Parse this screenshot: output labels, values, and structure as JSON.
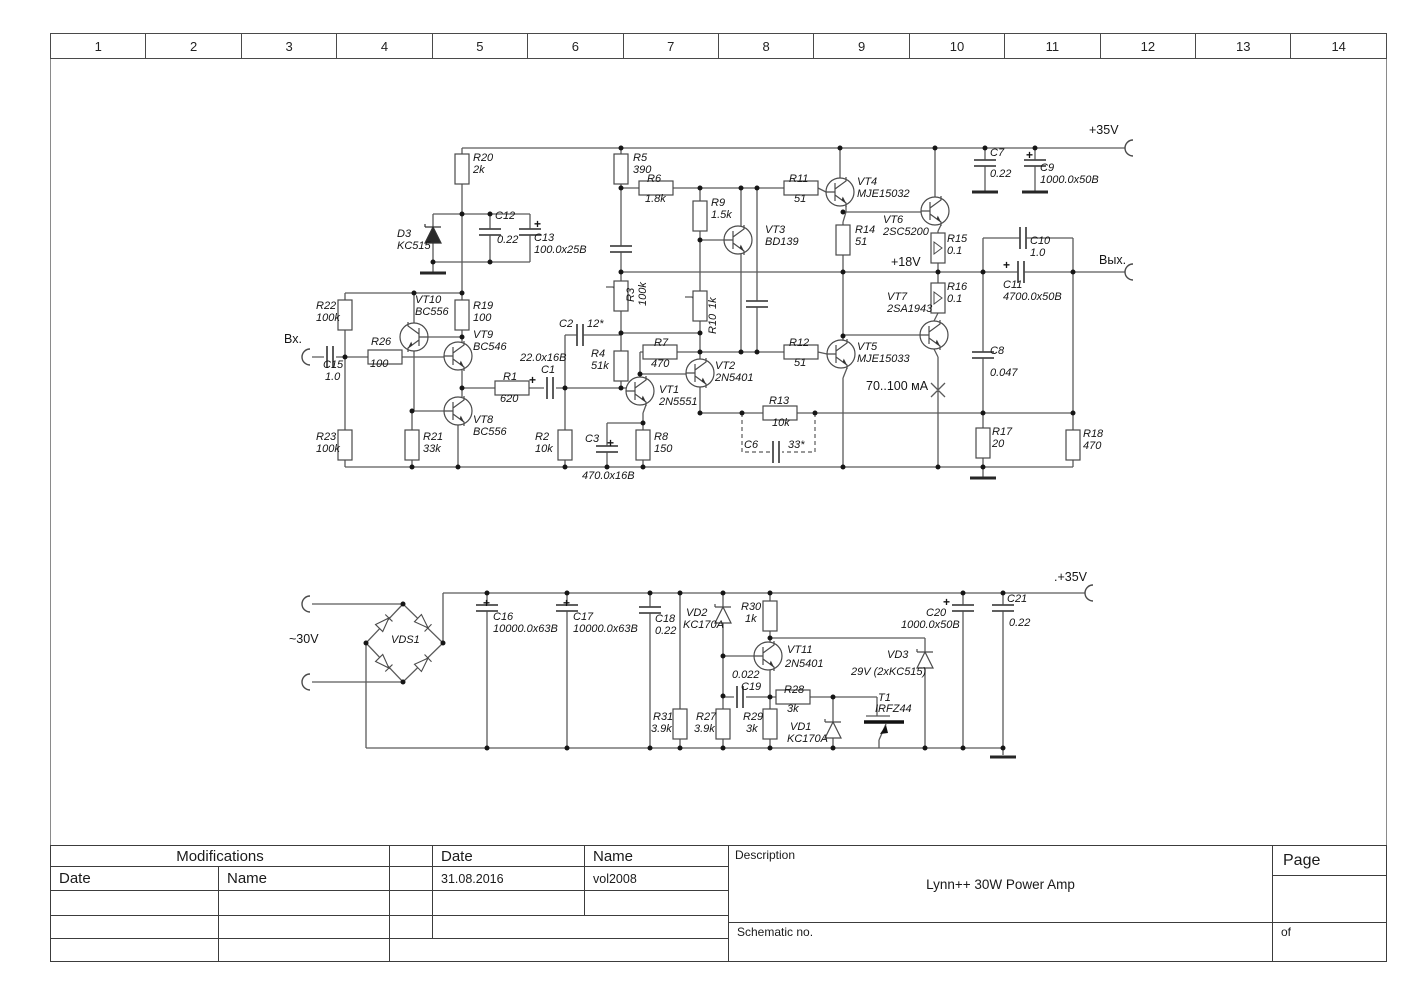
{
  "frame": {
    "columns": [
      "1",
      "2",
      "3",
      "4",
      "5",
      "6",
      "7",
      "8",
      "9",
      "10",
      "11",
      "12",
      "13",
      "14"
    ]
  },
  "title_block": {
    "modifications": "Modifications",
    "date_col": "Date",
    "name_col": "Name",
    "date_header": "Date",
    "name_header": "Name",
    "date_value": "31.08.2016",
    "name_value": "vol2008",
    "description_label": "Description",
    "description": "Lynn++ 30W Power Amp",
    "schematic_no_label": "Schematic no.",
    "page_label": "Page",
    "of_label": "of"
  },
  "schematic": {
    "labels": [
      {
        "x": 473,
        "y": 153,
        "t": "R20"
      },
      {
        "x": 473,
        "y": 165,
        "t": "2k"
      },
      {
        "x": 633,
        "y": 153,
        "t": "R5"
      },
      {
        "x": 633,
        "y": 165,
        "t": "390"
      },
      {
        "x": 647,
        "y": 174,
        "t": "R6"
      },
      {
        "x": 645,
        "y": 194,
        "t": "1.8k"
      },
      {
        "x": 711,
        "y": 198,
        "t": "R9"
      },
      {
        "x": 711,
        "y": 210,
        "t": "1.5k"
      },
      {
        "x": 765,
        "y": 225,
        "t": "VT3"
      },
      {
        "x": 765,
        "y": 237,
        "t": "BD139"
      },
      {
        "x": 789,
        "y": 174,
        "t": "R11"
      },
      {
        "x": 794,
        "y": 194,
        "t": "51"
      },
      {
        "x": 857,
        "y": 177,
        "t": "VT4"
      },
      {
        "x": 857,
        "y": 189,
        "t": "MJE15032"
      },
      {
        "x": 883,
        "y": 215,
        "t": "VT6"
      },
      {
        "x": 883,
        "y": 227,
        "t": "2SC5200"
      },
      {
        "x": 855,
        "y": 225,
        "t": "R14"
      },
      {
        "x": 855,
        "y": 237,
        "t": "51"
      },
      {
        "x": 947,
        "y": 234,
        "t": "R15"
      },
      {
        "x": 947,
        "y": 246,
        "t": "0.1"
      },
      {
        "x": 891,
        "y": 256,
        "t": "+18V",
        "c": "up"
      },
      {
        "x": 947,
        "y": 282,
        "t": "R16"
      },
      {
        "x": 947,
        "y": 294,
        "t": "0.1"
      },
      {
        "x": 887,
        "y": 292,
        "t": "VT7"
      },
      {
        "x": 887,
        "y": 304,
        "t": "2SA1943"
      },
      {
        "x": 990,
        "y": 148,
        "t": "C7"
      },
      {
        "x": 990,
        "y": 169,
        "t": "0.22"
      },
      {
        "x": 1026,
        "y": 149,
        "t": "+",
        "c": "plus"
      },
      {
        "x": 1040,
        "y": 163,
        "t": "C9"
      },
      {
        "x": 1040,
        "y": 175,
        "t": "1000.0x50B"
      },
      {
        "x": 1089,
        "y": 124,
        "t": "+35V",
        "c": "up"
      },
      {
        "x": 1030,
        "y": 236,
        "t": "C10"
      },
      {
        "x": 1030,
        "y": 248,
        "t": "1.0"
      },
      {
        "x": 1003,
        "y": 259,
        "t": "+",
        "c": "plus"
      },
      {
        "x": 1003,
        "y": 280,
        "t": "C11"
      },
      {
        "x": 1003,
        "y": 292,
        "t": "4700.0x50B"
      },
      {
        "x": 1099,
        "y": 254,
        "t": "Вых.",
        "c": "up"
      },
      {
        "x": 990,
        "y": 346,
        "t": "C8"
      },
      {
        "x": 990,
        "y": 368,
        "t": "0.047"
      },
      {
        "x": 397,
        "y": 229,
        "t": "D3"
      },
      {
        "x": 397,
        "y": 241,
        "t": "KC515"
      },
      {
        "x": 495,
        "y": 211,
        "t": "C12"
      },
      {
        "x": 497,
        "y": 235,
        "t": "0.22"
      },
      {
        "x": 534,
        "y": 218,
        "t": "+",
        "c": "plus"
      },
      {
        "x": 534,
        "y": 233,
        "t": "C13"
      },
      {
        "x": 534,
        "y": 245,
        "t": "100.0x25B"
      },
      {
        "x": 316,
        "y": 301,
        "t": "R22"
      },
      {
        "x": 316,
        "y": 313,
        "t": "100k"
      },
      {
        "x": 316,
        "y": 432,
        "t": "R23"
      },
      {
        "x": 316,
        "y": 444,
        "t": "100k"
      },
      {
        "x": 371,
        "y": 337,
        "t": "R26"
      },
      {
        "x": 370,
        "y": 359,
        "t": "100"
      },
      {
        "x": 415,
        "y": 295,
        "t": "VT10"
      },
      {
        "x": 415,
        "y": 307,
        "t": "BC556"
      },
      {
        "x": 473,
        "y": 330,
        "t": "VT9"
      },
      {
        "x": 473,
        "y": 342,
        "t": "BC546"
      },
      {
        "x": 473,
        "y": 301,
        "t": "R19"
      },
      {
        "x": 473,
        "y": 313,
        "t": "100"
      },
      {
        "x": 473,
        "y": 415,
        "t": "VT8"
      },
      {
        "x": 473,
        "y": 427,
        "t": "BC556"
      },
      {
        "x": 423,
        "y": 432,
        "t": "R21"
      },
      {
        "x": 423,
        "y": 444,
        "t": "33k"
      },
      {
        "x": 284,
        "y": 333,
        "t": "Вх.",
        "c": "up"
      },
      {
        "x": 323,
        "y": 360,
        "t": "C15"
      },
      {
        "x": 325,
        "y": 372,
        "t": "1.0"
      },
      {
        "x": 503,
        "y": 372,
        "t": "R1"
      },
      {
        "x": 500,
        "y": 394,
        "t": "620"
      },
      {
        "x": 520,
        "y": 353,
        "t": "22.0x16B"
      },
      {
        "x": 541,
        "y": 365,
        "t": "C1"
      },
      {
        "x": 529,
        "y": 374,
        "t": "+",
        "c": "plus"
      },
      {
        "x": 559,
        "y": 319,
        "t": "C2"
      },
      {
        "x": 587,
        "y": 319,
        "t": "12*"
      },
      {
        "x": 591,
        "y": 349,
        "t": "R4"
      },
      {
        "x": 591,
        "y": 361,
        "t": "51k"
      },
      {
        "x": 535,
        "y": 432,
        "t": "R2"
      },
      {
        "x": 535,
        "y": 444,
        "t": "10k"
      },
      {
        "x": 585,
        "y": 434,
        "t": "C3"
      },
      {
        "x": 607,
        "y": 437,
        "t": "+",
        "c": "plus"
      },
      {
        "x": 582,
        "y": 471,
        "t": "470.0x16B"
      },
      {
        "x": 654,
        "y": 432,
        "t": "R8"
      },
      {
        "x": 654,
        "y": 444,
        "t": "150"
      },
      {
        "x": 654,
        "y": 338,
        "t": "R7"
      },
      {
        "x": 651,
        "y": 359,
        "t": "470"
      },
      {
        "x": 659,
        "y": 385,
        "t": "VT1"
      },
      {
        "x": 659,
        "y": 397,
        "t": "2N5551"
      },
      {
        "x": 715,
        "y": 361,
        "t": "VT2"
      },
      {
        "x": 715,
        "y": 373,
        "t": "2N5401"
      },
      {
        "x": 626,
        "y": 302,
        "t": "R3",
        "c": "rot"
      },
      {
        "x": 638,
        "y": 306,
        "t": "100k",
        "c": "rot"
      },
      {
        "x": 708,
        "y": 334,
        "t": "R10",
        "c": "rot"
      },
      {
        "x": 708,
        "y": 309,
        "t": "1k",
        "c": "rot"
      },
      {
        "x": 789,
        "y": 338,
        "t": "R12"
      },
      {
        "x": 794,
        "y": 358,
        "t": "51"
      },
      {
        "x": 857,
        "y": 342,
        "t": "VT5"
      },
      {
        "x": 857,
        "y": 354,
        "t": "MJE15033"
      },
      {
        "x": 866,
        "y": 380,
        "t": "70..100 мА",
        "c": "up"
      },
      {
        "x": 769,
        "y": 396,
        "t": "R13"
      },
      {
        "x": 772,
        "y": 418,
        "t": "10k"
      },
      {
        "x": 744,
        "y": 440,
        "t": "C6"
      },
      {
        "x": 788,
        "y": 440,
        "t": "33*"
      },
      {
        "x": 992,
        "y": 427,
        "t": "R17"
      },
      {
        "x": 992,
        "y": 439,
        "t": "20"
      },
      {
        "x": 1083,
        "y": 429,
        "t": "R18"
      },
      {
        "x": 1083,
        "y": 441,
        "t": "470"
      },
      {
        "x": 289,
        "y": 633,
        "t": "~30V",
        "c": "up"
      },
      {
        "x": 391,
        "y": 635,
        "t": "VDS1"
      },
      {
        "x": 483,
        "y": 597,
        "t": "+",
        "c": "plus"
      },
      {
        "x": 493,
        "y": 612,
        "t": "C16"
      },
      {
        "x": 493,
        "y": 624,
        "t": "10000.0x63B"
      },
      {
        "x": 563,
        "y": 597,
        "t": "+",
        "c": "plus"
      },
      {
        "x": 573,
        "y": 612,
        "t": "C17"
      },
      {
        "x": 573,
        "y": 624,
        "t": "10000.0x63B"
      },
      {
        "x": 655,
        "y": 614,
        "t": "C18"
      },
      {
        "x": 655,
        "y": 626,
        "t": "0.22"
      },
      {
        "x": 686,
        "y": 608,
        "t": "VD2"
      },
      {
        "x": 683,
        "y": 620,
        "t": "KC170A"
      },
      {
        "x": 741,
        "y": 602,
        "t": "R30"
      },
      {
        "x": 745,
        "y": 614,
        "t": "1k"
      },
      {
        "x": 787,
        "y": 645,
        "t": "VT11"
      },
      {
        "x": 785,
        "y": 659,
        "t": "2N5401"
      },
      {
        "x": 732,
        "y": 670,
        "t": "0.022"
      },
      {
        "x": 741,
        "y": 682,
        "t": "C19"
      },
      {
        "x": 784,
        "y": 685,
        "t": "R28"
      },
      {
        "x": 787,
        "y": 704,
        "t": "3k"
      },
      {
        "x": 887,
        "y": 650,
        "t": "VD3"
      },
      {
        "x": 851,
        "y": 667,
        "t": "29V (2xKC515)"
      },
      {
        "x": 878,
        "y": 693,
        "t": "T1"
      },
      {
        "x": 875,
        "y": 704,
        "t": "IRFZ44"
      },
      {
        "x": 790,
        "y": 722,
        "t": "VD1"
      },
      {
        "x": 787,
        "y": 734,
        "t": "KC170A"
      },
      {
        "x": 653,
        "y": 712,
        "t": "R31"
      },
      {
        "x": 651,
        "y": 724,
        "t": "3.9k"
      },
      {
        "x": 696,
        "y": 712,
        "t": "R27"
      },
      {
        "x": 694,
        "y": 724,
        "t": "3.9k"
      },
      {
        "x": 743,
        "y": 712,
        "t": "R29"
      },
      {
        "x": 746,
        "y": 724,
        "t": "3k"
      },
      {
        "x": 926,
        "y": 608,
        "t": "C20"
      },
      {
        "x": 901,
        "y": 620,
        "t": "1000.0x50B"
      },
      {
        "x": 943,
        "y": 596,
        "t": "+",
        "c": "plus"
      },
      {
        "x": 1007,
        "y": 594,
        "t": "C21"
      },
      {
        "x": 1009,
        "y": 618,
        "t": "0.22"
      },
      {
        "x": 1054,
        "y": 571,
        "t": ".+35V",
        "c": "up"
      }
    ]
  }
}
